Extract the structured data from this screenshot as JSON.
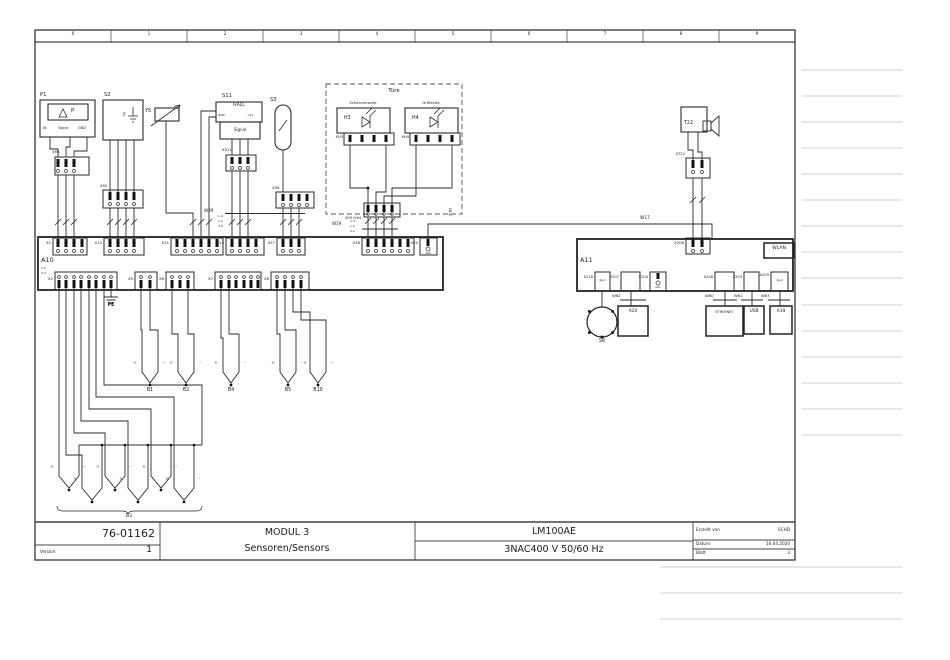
{
  "grid": [
    "0",
    "1",
    "2",
    "3",
    "4",
    "5",
    "6",
    "7",
    "8",
    "9"
  ],
  "title_block": {
    "part_number": "76-01162",
    "version_label": "Version",
    "version": "1",
    "module_title": "MODUL 3",
    "module_subtitle": "Sensoren/Sensors",
    "device": "LM100AE",
    "power": "3NAC400 V 50/60 Hz",
    "created_label": "Erstellt von",
    "created_by": "SCHD",
    "date_label": "Datum",
    "date": "16.04.2020",
    "sheet_label": "Blatt",
    "sheet": "3"
  },
  "components": {
    "p1": {
      "ref": "P1",
      "symbol": "P",
      "pin_in": "IN",
      "pin_signal": "Signal",
      "pin_gnd": "GND",
      "connector": "XH1"
    },
    "s2": {
      "ref": "S2",
      "pe": "PE",
      "connector": "X52"
    },
    "y5": {
      "ref": "Y5"
    },
    "s11": {
      "ref": "S11",
      "type": "HALL",
      "pin_gnd": "GND",
      "pin_5v": "+5V",
      "pin_signal": "Signal",
      "connector": "X511"
    },
    "s3": {
      "ref": "S3",
      "connector": "X58"
    },
    "door": {
      "title": "Türe",
      "hinge_side": "Scharnierseite",
      "handle_side": "Griffseite",
      "h3": "H3",
      "h4": "H4",
      "xh3": "XH3",
      "xh4": "XH4",
      "combined": "XH3 /XH4"
    },
    "t22": {
      "ref": "T22",
      "connector": "XT22"
    },
    "s6": {
      "ref": "S6"
    }
  },
  "boards": {
    "a10": {
      "ref": "A10",
      "xref_top": "1.2",
      "xref_bottom": "3.4",
      "x1": "X1",
      "x12": "X12",
      "x11": "X11",
      "x13": "X13",
      "x37": "X37",
      "x38": "X38",
      "x50": "X50",
      "kol": "KOL",
      "x2": "X2",
      "x5": "X5",
      "x6": "X6",
      "x7": "X7",
      "x8": "X8",
      "pe": "PE"
    },
    "a11": {
      "ref": "A11",
      "x206": "X206",
      "wlan": "WLAN",
      "x218": "X218",
      "pol6": "6pol",
      "x207": "X207",
      "x204": "X204",
      "kol": "KOL",
      "x208": "X208",
      "x203": "X203",
      "x209": "X209",
      "pol4": "4pol"
    }
  },
  "cables": {
    "w29": {
      "name": "W29",
      "cond": [
        "1.4",
        "1.5",
        "3.6"
      ]
    },
    "w19": {
      "name": "W19",
      "cond": [
        "1.4",
        "1.3",
        "3.2"
      ]
    },
    "w17": "W17",
    "w60": "W60",
    "w61": "W61",
    "w62": "W62",
    "w63": "W63",
    "xref": "/5.B3"
  },
  "devices": {
    "a20": "A20",
    "ethernet": "ETHERNET",
    "usb": "USB",
    "a19": "A19"
  },
  "sensors": {
    "b1": "B1",
    "b2": "B2",
    "b3": "B3",
    "b4": "B4",
    "b5": "B5",
    "b10": "B10",
    "plus": "+",
    "minus": "-"
  }
}
